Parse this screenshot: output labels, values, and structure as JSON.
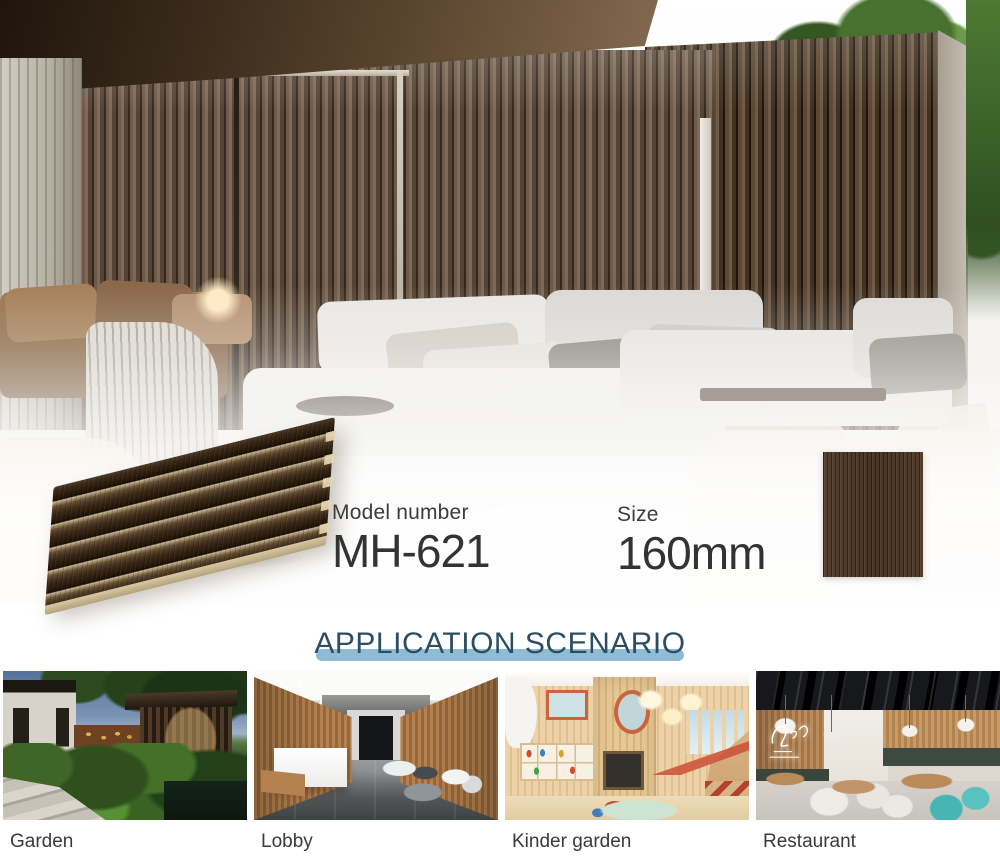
{
  "product": {
    "model": {
      "label": "Model number",
      "value": "MH-621"
    },
    "size": {
      "label": "Size",
      "value": "160mm"
    }
  },
  "application": {
    "title": "APPLICATION SCENARIO",
    "items": [
      {
        "label": "Garden"
      },
      {
        "label": "Lobby"
      },
      {
        "label": "Kinder garden"
      },
      {
        "label": "Restaurant"
      }
    ]
  },
  "colors": {
    "title_text": "#2c4d63",
    "title_underline": "#8fbcd4",
    "info_text": "#3b3b3b",
    "caption_text": "#3a3a3a",
    "hero_slat_brown": "#6e5a48",
    "panel_wood_dark": "#2f2012",
    "panel_wood_light": "#d9c6a0",
    "swatch_wood": "#4c392a"
  },
  "icons": {
    "neon_sign": "neon-script-sign"
  }
}
